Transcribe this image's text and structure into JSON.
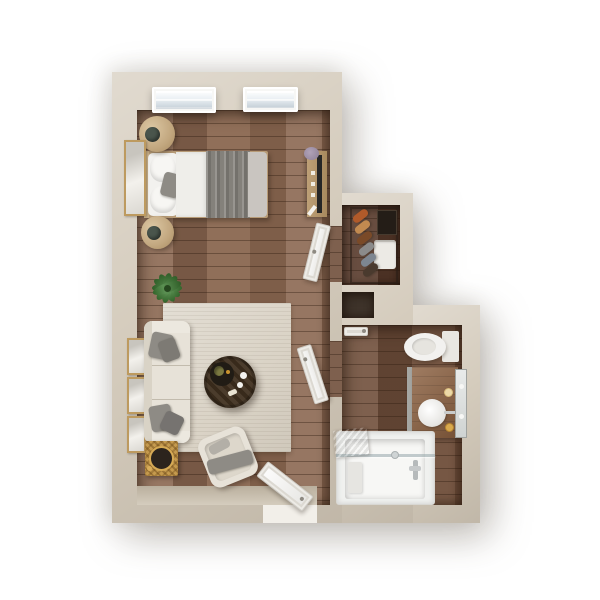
{
  "meta": {
    "title": "studio-apartment-3d-floor-plan",
    "view": "top-down"
  },
  "palette": {
    "background": "#ffffff",
    "wall": "#d5ccbd",
    "floor_main": "#8a6750",
    "floor_bath": "#6f4e3a",
    "floor_closet": "#57392a",
    "entry_floor": "#cfc6b5",
    "doorway_gap": "#f2efe9",
    "rug": "#dad3c6",
    "sofa": "#e7e2d8",
    "pillow_gray": "#8e8b85",
    "bed_blanket": "#84817b",
    "coffee_table": "#40301f",
    "side_table": "#c59a4e",
    "plant": "#3f7d35",
    "vanity_wood": "#8a5f3f",
    "skylight_glass": "#e4ebf0",
    "garments": [
      "#b05a2a",
      "#c28a50",
      "#7a4a28",
      "#8b8b8b",
      "#7d8691",
      "#4a3a2e"
    ]
  },
  "rooms": [
    {
      "name": "living-bedroom"
    },
    {
      "name": "closet"
    },
    {
      "name": "bathroom"
    }
  ],
  "objects": [
    "skylight",
    "double-bed",
    "nightstand-basket",
    "wall-art",
    "media-console",
    "tv",
    "potted-plant",
    "area-rug",
    "sofa",
    "coffee-table",
    "accent-chair",
    "rattan-side-table",
    "entry-door",
    "closet-door",
    "bathroom-door",
    "hanging-clothes",
    "shelf-box",
    "towel-basket",
    "toilet",
    "vanity-sink",
    "mirror",
    "candles",
    "bathtub",
    "shower-glass",
    "towel"
  ]
}
